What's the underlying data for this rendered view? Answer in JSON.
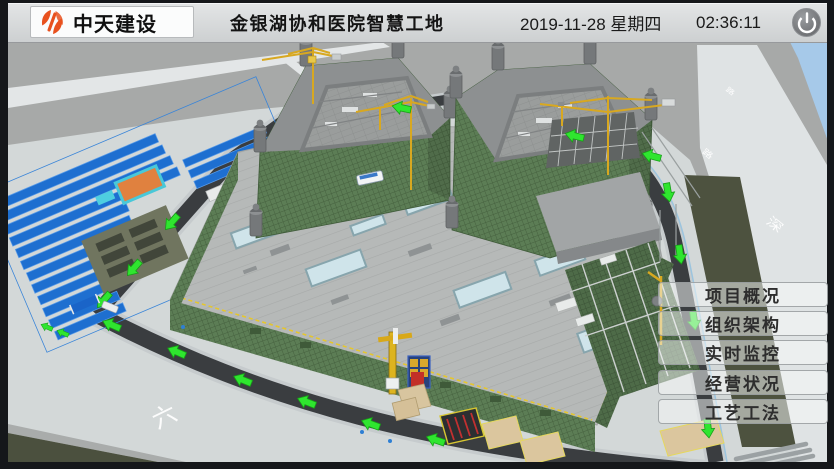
{
  "header": {
    "brand": "中天建设",
    "title": "金银湖协和医院智慧工地",
    "date": "2019-11-28 星期四",
    "time": "02:36:11"
  },
  "menu": {
    "items": [
      {
        "label": "项目概况"
      },
      {
        "label": "组织架构"
      },
      {
        "label": "实时监控"
      },
      {
        "label": "经营状况"
      },
      {
        "label": "工艺工法"
      }
    ]
  },
  "scene": {
    "road_labels": [
      {
        "text": "六"
      },
      {
        "text": "深"
      },
      {
        "text": "路"
      },
      {
        "text": "路"
      }
    ],
    "colors": {
      "arrow_green": "#2fe52f",
      "mesh_green": "#5c7d55",
      "asphalt": "#3a3d40",
      "brand_orange": "#e8511e",
      "sky_blue": "#a6c9e9",
      "camp_roof_blue": "#1e6fd0"
    }
  }
}
